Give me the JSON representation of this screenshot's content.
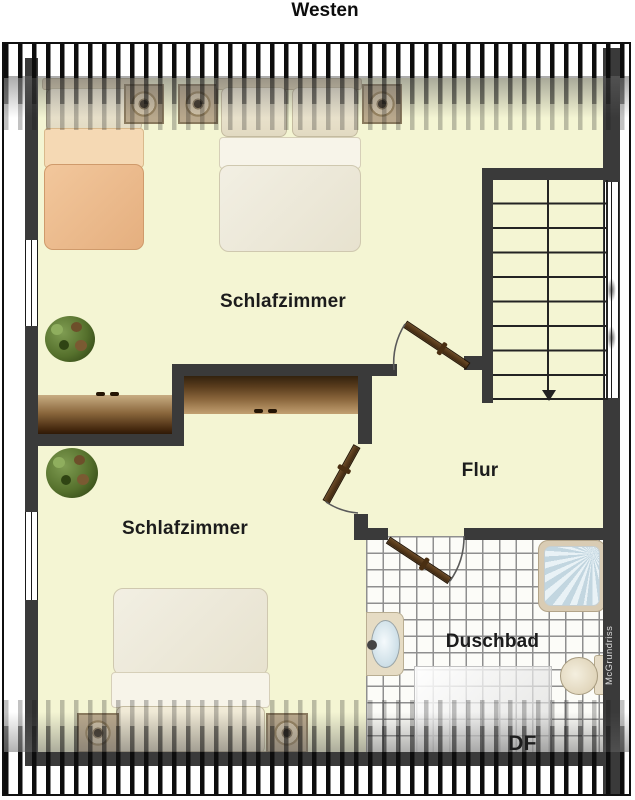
{
  "title": "Westen",
  "watermark": "McGrundriss",
  "labels": {
    "bedroom_top": "Schlafzimmer",
    "bedroom_bottom": "Schlafzimmer",
    "hallway": "Flur",
    "bathroom": "Duschbad",
    "roof_window": "DF"
  },
  "stairs": {
    "tread_rows": 9,
    "direction": "down"
  },
  "colors": {
    "floor": "#f4f5d3",
    "wall": "#3a3a3a",
    "hatch_stripe": "#0d0d0d",
    "tile_background": "#fcfcf8",
    "blanket_peach": "#e5af7f",
    "duvet_white": "#ece8d8",
    "furniture_brown": "#5a3d1d",
    "plant_green": "#55702c",
    "shower_blue": "#cfe0e8"
  }
}
